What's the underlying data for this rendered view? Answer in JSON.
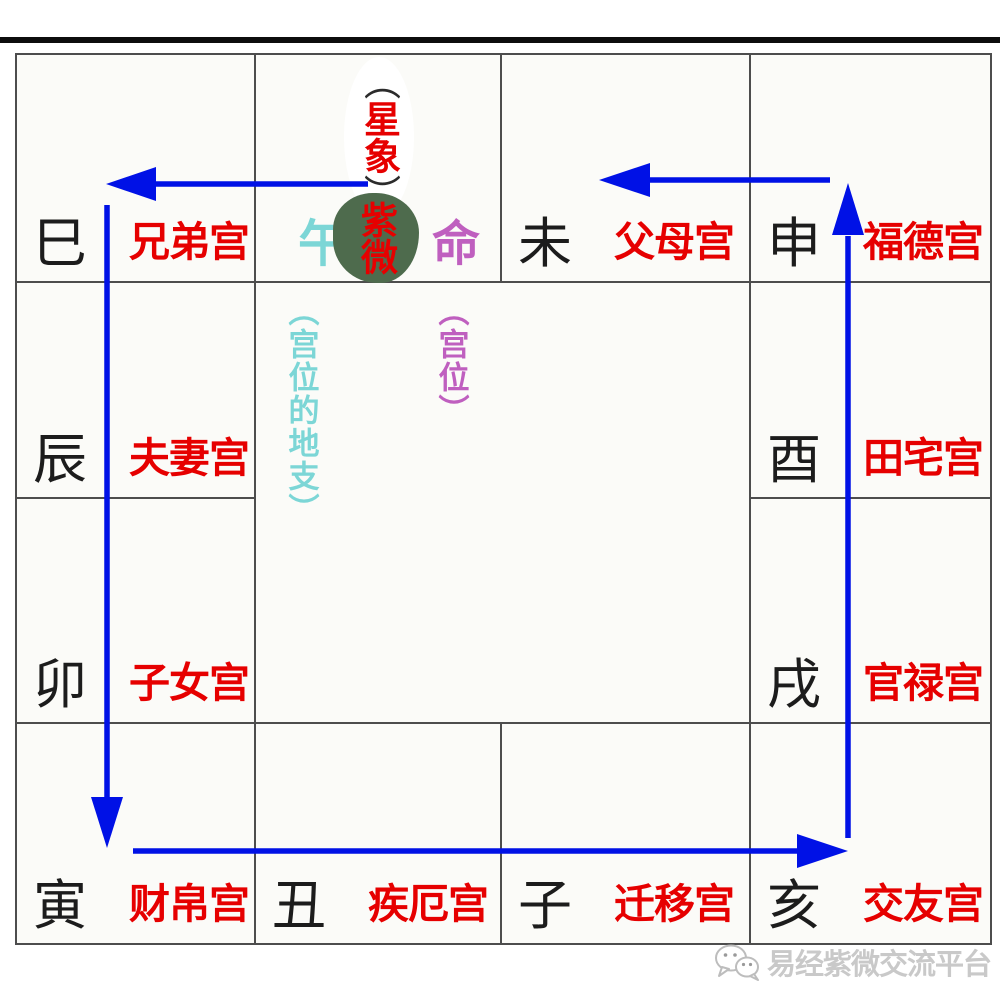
{
  "colors": {
    "arrow_blue": "#0011e6",
    "palace_red": "#e60000",
    "branch_black": "#1c1c1c",
    "cyan_text": "#7cd6d6",
    "magenta_text": "#bf5fbf",
    "blob_green": "#4e6b4d",
    "grid_line": "#4d4d4d",
    "watermark_gray": "#c9c9c9"
  },
  "ming_cell": {
    "branch": "午",
    "star_name": "紫微",
    "palace": "命",
    "star_note_open": "（",
    "star_note_text": "星象",
    "star_note_close": "）"
  },
  "center": {
    "branch_note": "（宫位的地支）",
    "palace_note": "（宫位）"
  },
  "cells": [
    {
      "id": "si",
      "branch": "巳",
      "palace": "兄弟宫"
    },
    {
      "id": "wei",
      "branch": "未",
      "palace": "父母宫"
    },
    {
      "id": "shen",
      "branch": "申",
      "palace": "福德宫"
    },
    {
      "id": "chen",
      "branch": "辰",
      "palace": "夫妻宫"
    },
    {
      "id": "you",
      "branch": "酉",
      "palace": "田宅宫"
    },
    {
      "id": "mao",
      "branch": "卯",
      "palace": "子女宫"
    },
    {
      "id": "xu",
      "branch": "戌",
      "palace": "官禄宫"
    },
    {
      "id": "yin",
      "branch": "寅",
      "palace": "财帛宫"
    },
    {
      "id": "chou",
      "branch": "丑",
      "palace": "疾厄宫"
    },
    {
      "id": "zi",
      "branch": "子",
      "palace": "迁移宫"
    },
    {
      "id": "hai",
      "branch": "亥",
      "palace": "交友宫"
    }
  ],
  "watermark": {
    "icon": "wechat-icon",
    "text": "易经紫微交流平台"
  }
}
